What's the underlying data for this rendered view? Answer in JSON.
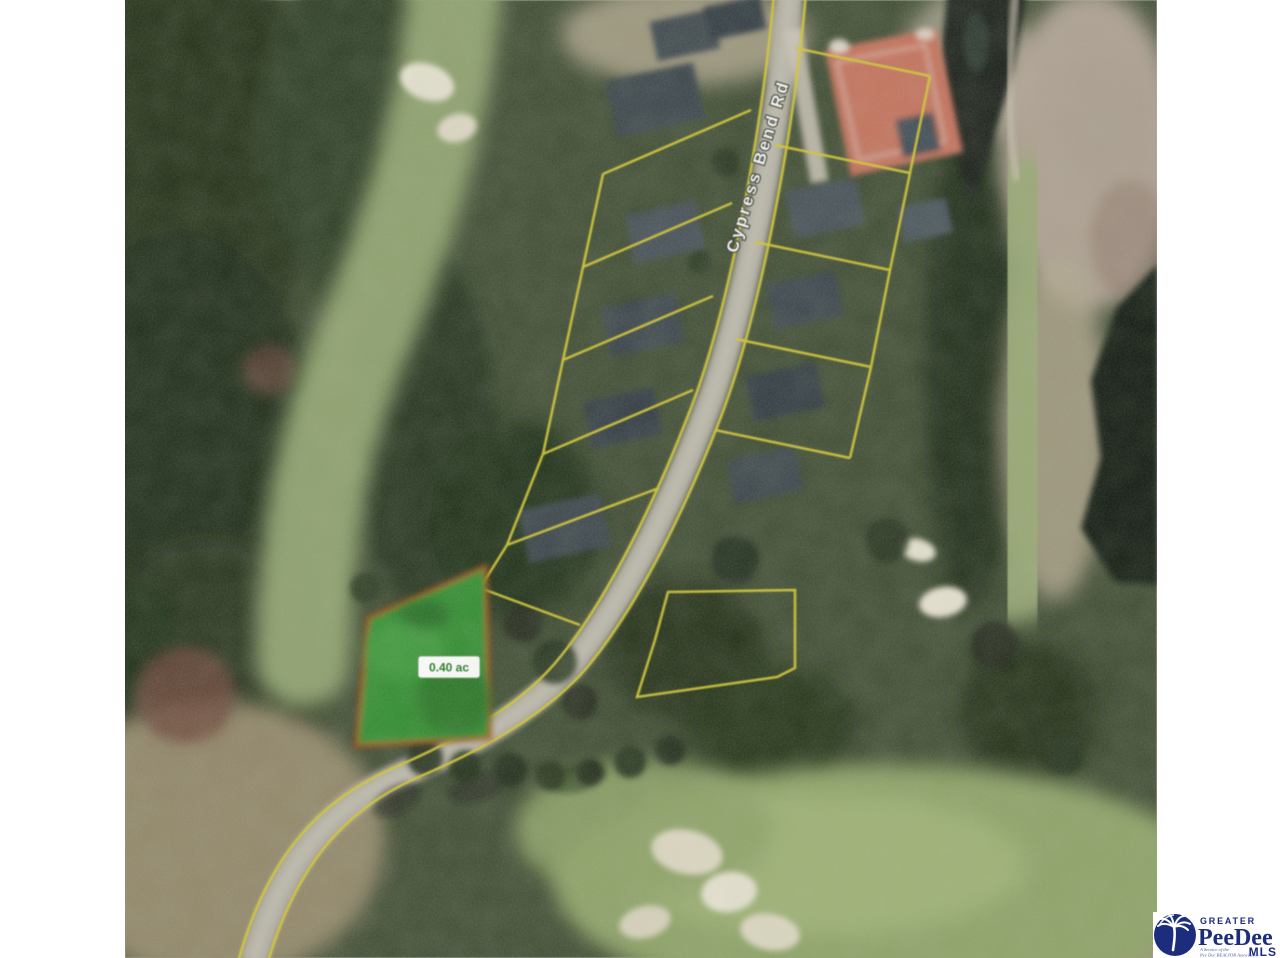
{
  "map": {
    "kind": "aerial-parcel-photo",
    "road_label": "Cypress Bend Rd",
    "subject_lot": {
      "size_label": "0.40 ac"
    },
    "colors": {
      "parcel_line_yellow": "#d4c82e",
      "subject_lot_outline": "#a9440e",
      "subject_lot_fill": "#2f8c2f",
      "lot_label_text": "#1f7a1f",
      "road_gray": "#b3afa3",
      "forest_dark_green": "#26331f",
      "fairway_green": "#8fa368",
      "water_dark": "#10180f",
      "sand_white": "#e6e2d0",
      "roof_red": "#c4705a"
    }
  },
  "logo": {
    "greater": "GREATER",
    "brand": "PeeDee",
    "mls": "MLS",
    "tagline_line1": "A Service of the",
    "tagline_line2": "Pee Dee REALTOR Association",
    "navy": "#1d2d7e",
    "icon": "palmetto-tree-icon"
  }
}
